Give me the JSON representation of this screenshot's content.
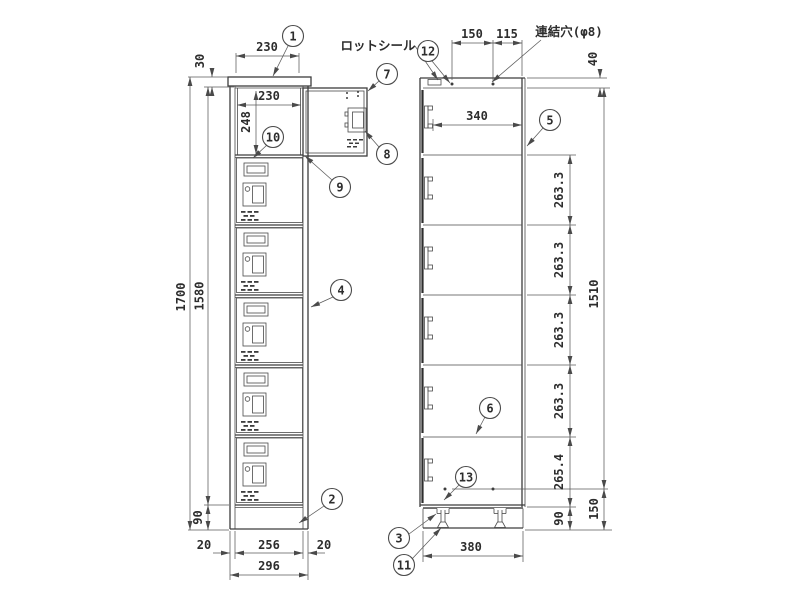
{
  "labels": {
    "lot_seal": "ロットシール",
    "link_hole": "連結穴(φ8)"
  },
  "front": {
    "top_width": "230",
    "plate": "30",
    "inner_width": "230",
    "inner_height": "248",
    "total_height": "1700",
    "body_height": "1580",
    "base_height": "90",
    "bottom": {
      "left": "20",
      "door": "256",
      "right": "20",
      "overall": "296"
    }
  },
  "side": {
    "top_front": "150",
    "top_back": "115",
    "top_margin": "40",
    "depth": "340",
    "comp": [
      "263.3",
      "263.3",
      "263.3",
      "263.3"
    ],
    "bottom_comp": "265.4",
    "base_height": "90",
    "body_span": "1510",
    "base_span": "150",
    "base_depth": "380"
  },
  "balloons": {
    "b1": "1",
    "b2": "2",
    "b3": "3",
    "b4": "4",
    "b5": "5",
    "b6": "6",
    "b7": "7",
    "b8": "8",
    "b9": "9",
    "b10": "10",
    "b11": "11",
    "b12": "12",
    "b13": "13"
  }
}
